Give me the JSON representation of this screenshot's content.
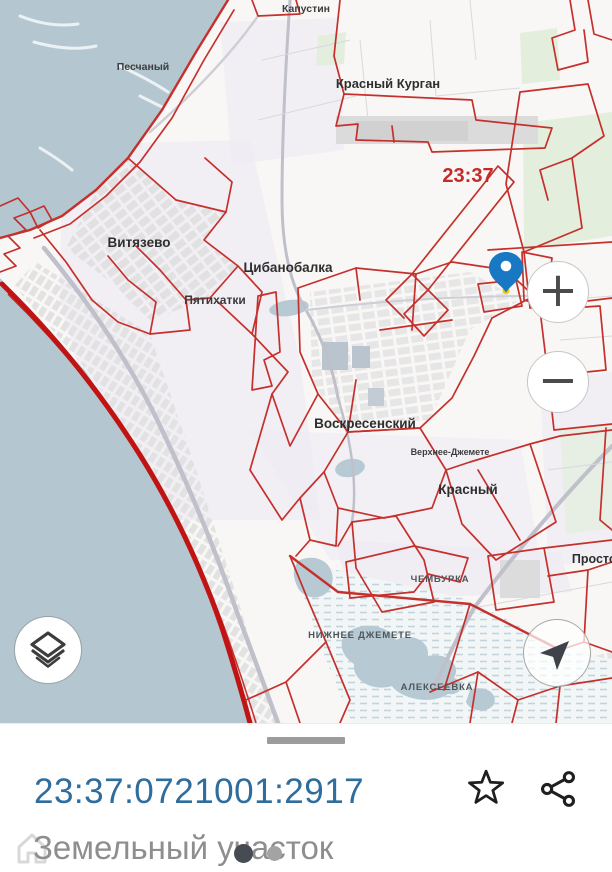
{
  "map": {
    "region_code_label": {
      "text": "23:37",
      "x": 468,
      "y": 182,
      "size": 20,
      "color": "#c32b28",
      "weight": "bold"
    },
    "places": [
      {
        "name": "kapustin",
        "text": "Капустин",
        "x": 306,
        "y": 12,
        "size": 10.5,
        "color": "#3d3d3d",
        "weight": "bold"
      },
      {
        "name": "peschany",
        "text": "Песчаный",
        "x": 143,
        "y": 70,
        "size": 10.5,
        "color": "#3d3d3d",
        "weight": "bold"
      },
      {
        "name": "krasny-kurgan",
        "text": "Красный Курган",
        "x": 388,
        "y": 88,
        "size": 13,
        "color": "#2e2e2e",
        "weight": "bold"
      },
      {
        "name": "vityazevo",
        "text": "Витязево",
        "x": 139,
        "y": 247,
        "size": 13.5,
        "color": "#2e2e2e",
        "weight": "bold"
      },
      {
        "name": "tsibanobalka",
        "text": "Цибанобалка",
        "x": 288,
        "y": 272,
        "size": 13.5,
        "color": "#2e2e2e",
        "weight": "bold"
      },
      {
        "name": "pyatikhatki",
        "text": "Пятихатки",
        "x": 215,
        "y": 304,
        "size": 12,
        "color": "#3a3a3a",
        "weight": "bold"
      },
      {
        "name": "voskresensky",
        "text": "Воскресенский",
        "x": 365,
        "y": 428,
        "size": 13.5,
        "color": "#2e2e2e",
        "weight": "bold"
      },
      {
        "name": "verkhnee-dzhemete",
        "text": "Верхнее-Джемете",
        "x": 450,
        "y": 455,
        "size": 9,
        "color": "#3d3d3d",
        "weight": "bold"
      },
      {
        "name": "krasny",
        "text": "Красный",
        "x": 468,
        "y": 494,
        "size": 13.5,
        "color": "#2e2e2e",
        "weight": "bold"
      },
      {
        "name": "prostor",
        "text": "Простор",
        "x": 598,
        "y": 563,
        "size": 12.5,
        "color": "#2e2e2e",
        "weight": "bold"
      },
      {
        "name": "chemburka",
        "text": "ЧЕМБУРКА",
        "x": 440,
        "y": 582,
        "size": 9.5,
        "color": "#4e565c",
        "weight": "bold",
        "spacing": 0.8
      },
      {
        "name": "nizhnee-dzhemete",
        "text": "НИЖНЕЕ ДЖЕМЕТЕ",
        "x": 360,
        "y": 638,
        "size": 9.5,
        "color": "#4e565c",
        "weight": "bold",
        "spacing": 0.8
      },
      {
        "name": "alekseevka",
        "text": "АЛЕКСЕЕВКА",
        "x": 437,
        "y": 690,
        "size": 9.5,
        "color": "#4e565c",
        "weight": "bold",
        "spacing": 0.8
      }
    ],
    "pin": {
      "x": 506,
      "y": 271,
      "body_color": "#1878c4",
      "hole_color": "#ffffff",
      "tip_dot_color": "#f4c900"
    },
    "colors": {
      "sea": "#b4c7d1",
      "land": "#f8f7f5",
      "parcel_boundary": "#c5302c",
      "coast_boundary": "#bf1413"
    }
  },
  "controls": {
    "zoom_in_label": "+",
    "zoom_out_label": "−",
    "layers_icon": "layers-icon",
    "compass_icon": "compass-arrow-icon"
  },
  "sheet": {
    "cadastral_number": "23:37:0721001:2917",
    "subtitle": "Земельный участок",
    "link_color": "#2e6d9d",
    "favorite_icon": "star-icon",
    "share_icon": "share-icon",
    "page_dots": [
      {
        "active": true
      },
      {
        "active": false
      }
    ]
  }
}
